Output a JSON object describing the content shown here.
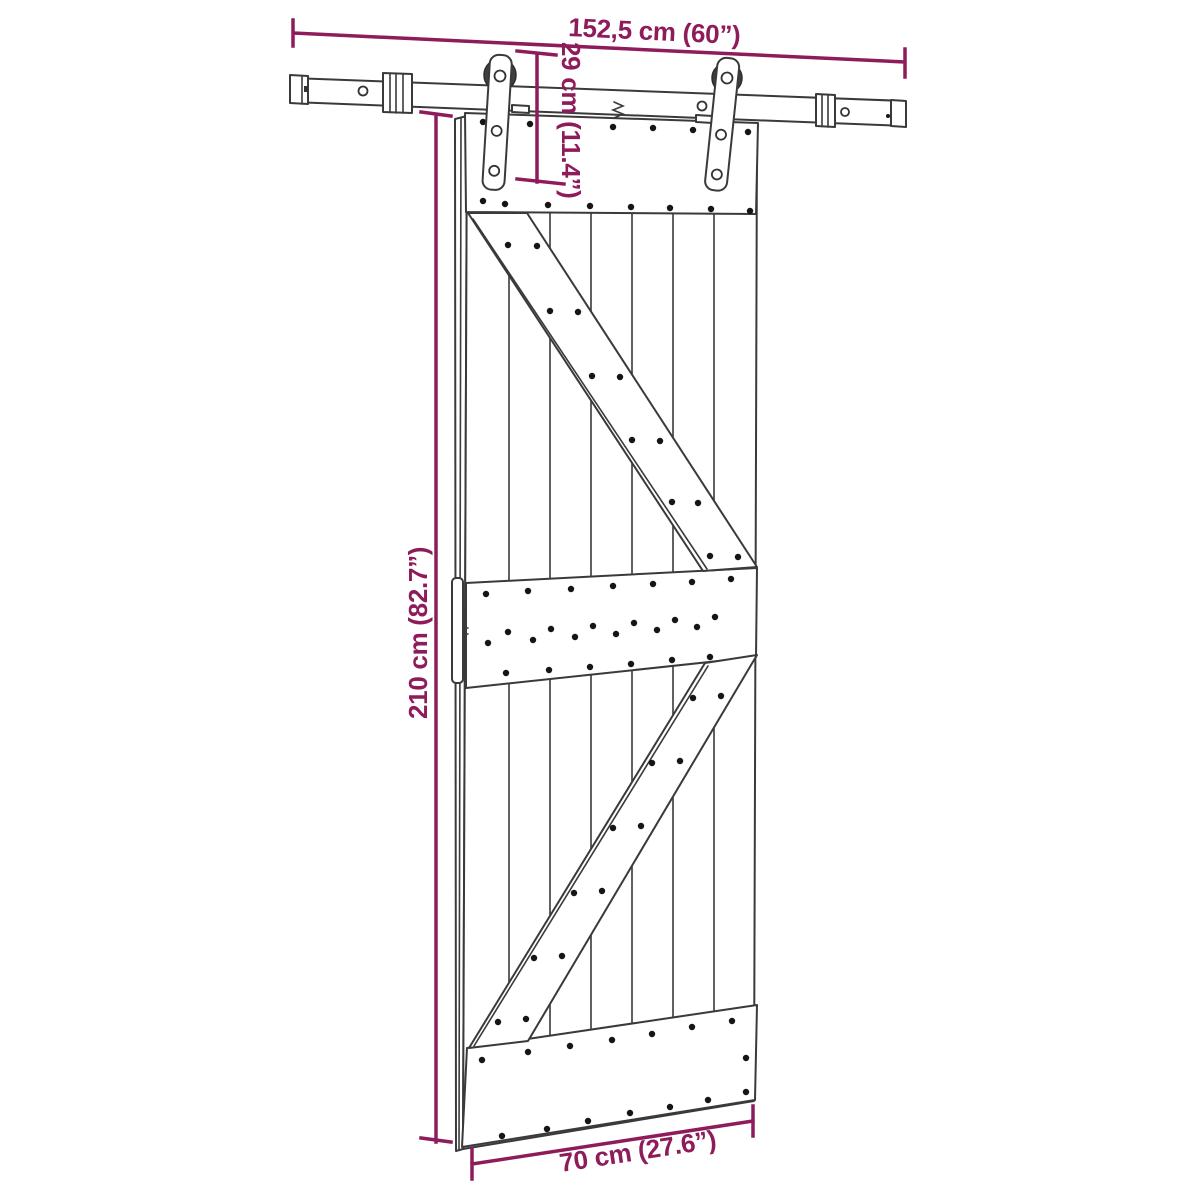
{
  "diagram": {
    "kind": "product-dimension-diagram",
    "subject": "sliding barn door with top-mounted roller track hardware",
    "colors": {
      "dimension_accent": "#8E1C5B",
      "drawing_line": "#3A3A3A",
      "background": "#FFFFFF"
    },
    "dimensions": {
      "track_width": {
        "label": "152,5 cm (60”)",
        "cm": "152,5",
        "inches": "60",
        "orientation": "horizontal-top"
      },
      "hanger_height": {
        "label": "29 cm (11.4”)",
        "cm": "29",
        "inches": "11.4",
        "orientation": "vertical-top"
      },
      "door_height": {
        "label": "210 cm (82.7”)",
        "cm": "210",
        "inches": "82.7",
        "orientation": "vertical-left"
      },
      "door_width": {
        "label": "70 cm (27.6”)",
        "cm": "70",
        "inches": "27.6",
        "orientation": "horizontal-bottom"
      }
    }
  }
}
